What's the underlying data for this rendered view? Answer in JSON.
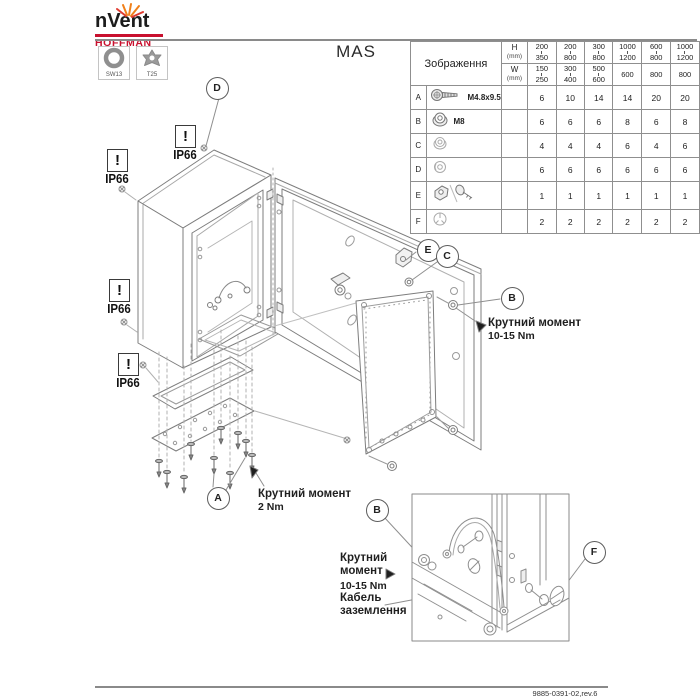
{
  "header": {
    "brand": "nVent",
    "brand_sub": "HOFFMAN",
    "tools": [
      {
        "label": "SW13",
        "icon": "hex-socket-icon"
      },
      {
        "label": "T25",
        "icon": "torx-icon"
      }
    ]
  },
  "title": "MAS",
  "table": {
    "image_header": "Зображення",
    "h_label": "H",
    "w_label": "W",
    "mm_label": "(mm)",
    "size_columns": [
      {
        "h": [
          "200",
          "350"
        ],
        "w": [
          "150",
          "250"
        ]
      },
      {
        "h": [
          "200",
          "800"
        ],
        "w": [
          "300",
          "400"
        ]
      },
      {
        "h": [
          "300",
          "800"
        ],
        "w": [
          "500",
          "600"
        ]
      },
      {
        "h": [
          "1000",
          "1200"
        ],
        "w": [
          "600"
        ]
      },
      {
        "h": [
          "600",
          "800"
        ],
        "w": [
          "800"
        ]
      },
      {
        "h": [
          "1000",
          "1200"
        ],
        "w": [
          "800"
        ]
      }
    ],
    "rows": [
      {
        "id": "A",
        "part": "M4.8x9.5",
        "icon": "screw-icon",
        "qty": [
          "6",
          "10",
          "14",
          "14",
          "20",
          "20"
        ]
      },
      {
        "id": "B",
        "part": "M8",
        "icon": "flange-nut-icon",
        "qty": [
          "6",
          "6",
          "6",
          "8",
          "6",
          "8"
        ]
      },
      {
        "id": "C",
        "part": "",
        "icon": "nut-icon",
        "qty": [
          "4",
          "4",
          "4",
          "6",
          "4",
          "6"
        ]
      },
      {
        "id": "D",
        "part": "",
        "icon": "washer-icon",
        "qty": [
          "6",
          "6",
          "6",
          "6",
          "6",
          "6"
        ]
      },
      {
        "id": "E",
        "part": "",
        "icon": "bracket-and-key-icon",
        "qty": [
          "1",
          "1",
          "1",
          "1",
          "1",
          "1"
        ]
      },
      {
        "id": "F",
        "part": "",
        "icon": "plug-icon",
        "qty": [
          "2",
          "2",
          "2",
          "2",
          "2",
          "2"
        ]
      }
    ]
  },
  "warnings": {
    "mark": "!",
    "ip": "IP66"
  },
  "callouts": [
    {
      "label": "D"
    },
    {
      "label": "E"
    },
    {
      "label": "C"
    },
    {
      "label": "B"
    },
    {
      "label": "A"
    },
    {
      "label": "B"
    },
    {
      "label": "F"
    }
  ],
  "annotations": {
    "torque_upper": {
      "line1": "Крутний момент",
      "line2": "10-15 Nm"
    },
    "torque_lower": {
      "line1": "Крутний момент",
      "line2": "2 Nm"
    },
    "inset_torque": {
      "line1": "Крутний",
      "line2": "момент",
      "line3": "10-15 Nm"
    },
    "ground": {
      "line1": "Кабель",
      "line2": "заземлення"
    }
  },
  "footer": {
    "doc_number": "9885-0391-02,rev.6"
  },
  "colors": {
    "brand_red": "#c8102e",
    "spark_orange": "#f0801a",
    "line_gray": "#7d7d7d"
  }
}
